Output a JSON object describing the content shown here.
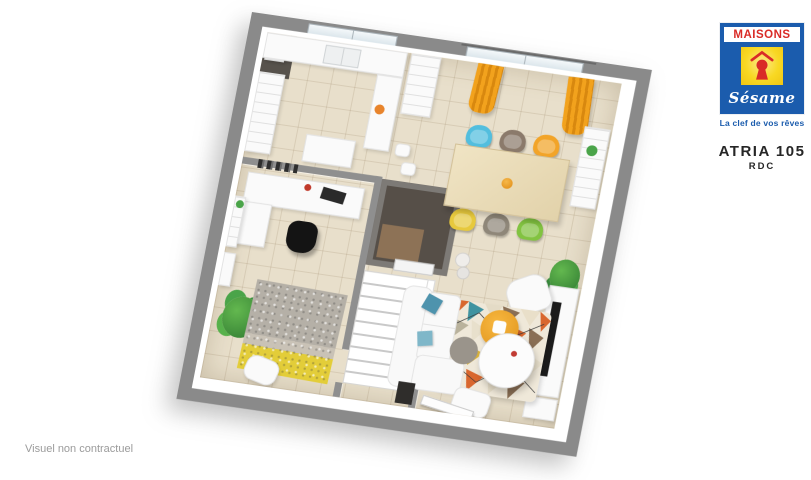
{
  "header": {
    "logo": {
      "brand_name_top": "MAISONS",
      "brand_name_script": "Sésame",
      "tagline": "La clef de vos rêves",
      "icon": "keyhole-roof-icon",
      "colors": {
        "blue": "#1b5cad",
        "red": "#d92b27",
        "yellow": "#f8d823"
      }
    },
    "model_name": "ATRIA 105",
    "level_label": "RDC"
  },
  "footer": {
    "disclaimer": "Visuel non contractuel"
  },
  "floorplan": {
    "description": "3D top-down rendering of the ground floor (RDC)",
    "wall_color": "#8a8a8a",
    "floor_color": "#e8dfcb",
    "accents": {
      "curtain_orange": "#ef9d1e",
      "dining_chair_colors": [
        "#52bede",
        "#8b7a6b",
        "#f2a428",
        "#e7c93d",
        "#8f8779",
        "#82c341"
      ],
      "pouf_orange": "#eda226",
      "living_rug_palette": [
        "#d9672e",
        "#3f93a0",
        "#8a6f55",
        "#e9e0cd",
        "#d9b23a"
      ],
      "plant_green": "#3c9140",
      "office_rug_yellow": "#e3cd39",
      "dark_room_color": "#564f48"
    }
  }
}
